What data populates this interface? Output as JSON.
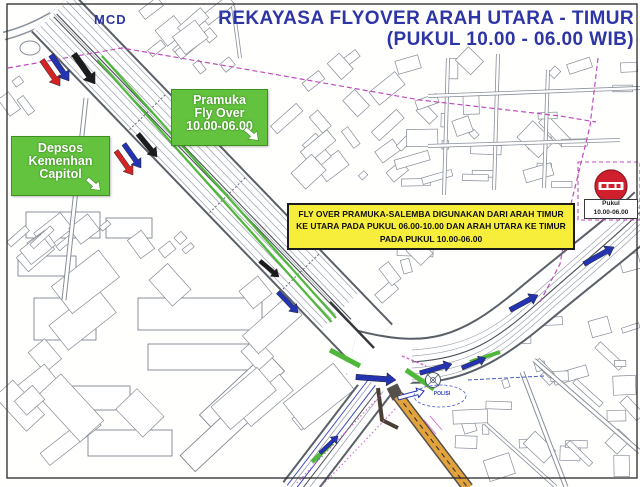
{
  "title": {
    "line1": "REKAYASA FLYOVER ARAH UTARA - TIMUR",
    "line2": "(PUKUL 10.00 - 06.00 WIB)"
  },
  "map_labels": {
    "mcd": "MCD",
    "polisi": "POLISI"
  },
  "callouts": {
    "pramuka": {
      "lines": [
        "Pramuka",
        "Fly Over",
        "10.00-06.00"
      ]
    },
    "depsos": {
      "lines": [
        "Depsos",
        "Kemenhan",
        "Capitol"
      ]
    },
    "notice": {
      "text": "FLY OVER PRAMUKA-SALEMBA DIGUNAKAN DARI ARAH TIMUR KE UTARA PADA PUKUL 06.00-10.00 DAN ARAH UTARA KE TIMUR PADA PUKUL 10.00-06.00"
    },
    "no_entry_caption": {
      "line1": "Pukul",
      "line2": "10.00-06.00"
    }
  },
  "symbols": {
    "no_entry_sign": "no-entry-icon",
    "roundabout": "roundabout-circle",
    "flyover_highlight": "green-route-stripe",
    "contra_flow_route": "orange-route-stripe"
  },
  "colors": {
    "title_blue": "#2e35a6",
    "callout_green": "#63c23e",
    "notice_yellow": "#f7ee3b",
    "no_entry_red": "#d0202e",
    "arrow_blue": "#2433b0",
    "arrow_red": "#d42323",
    "arrow_black": "#1c1c1c",
    "flyover_green": "#4fb83a",
    "route_orange": "#e2a33c",
    "boundary_magenta": "#c04ac0",
    "map_line_gray": "#8a8f98"
  }
}
